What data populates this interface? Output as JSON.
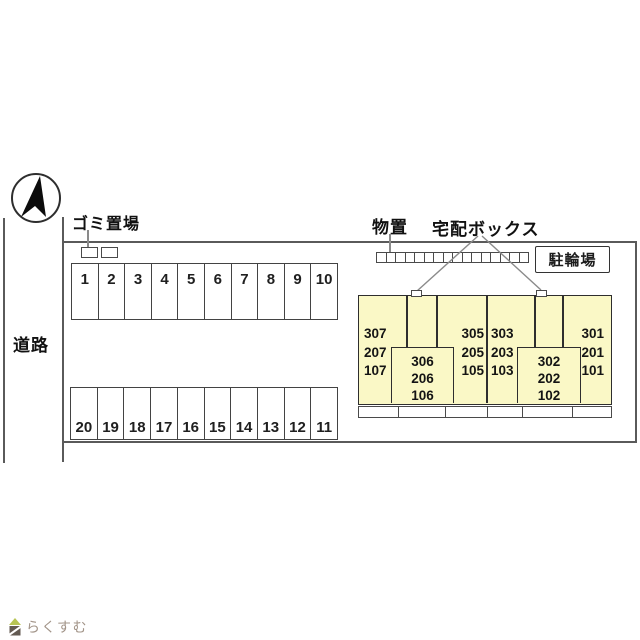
{
  "labels": {
    "road": "道路",
    "garbage": "ゴミ置場",
    "storage": "物置",
    "delivery_box": "宅配ボックス",
    "bicycle_parking": "駐輪場"
  },
  "parking": {
    "top_row": [
      "1",
      "2",
      "3",
      "4",
      "5",
      "6",
      "7",
      "8",
      "9",
      "10"
    ],
    "bottom_row": [
      "20",
      "19",
      "18",
      "17",
      "16",
      "15",
      "14",
      "13",
      "12",
      "11"
    ]
  },
  "building": {
    "fill_color": "#faf8c6",
    "unit_stacks": {
      "left_end": [
        "307",
        "207",
        "107"
      ],
      "left_inner_box": [
        "306",
        "206",
        "106"
      ],
      "left_of_center": [
        "305",
        "205",
        "105"
      ],
      "right_of_center": [
        "303",
        "203",
        "103"
      ],
      "right_inner_box": [
        "302",
        "202",
        "102"
      ],
      "right_end": [
        "301",
        "201",
        "101"
      ]
    }
  },
  "icons": {
    "compass": "north-arrow",
    "logo_house": "house-icon"
  },
  "footer_logo": {
    "text": "らくすむ",
    "roof_color": "#b7c454",
    "body_color": "#635a52",
    "text_color": "#a29488"
  }
}
